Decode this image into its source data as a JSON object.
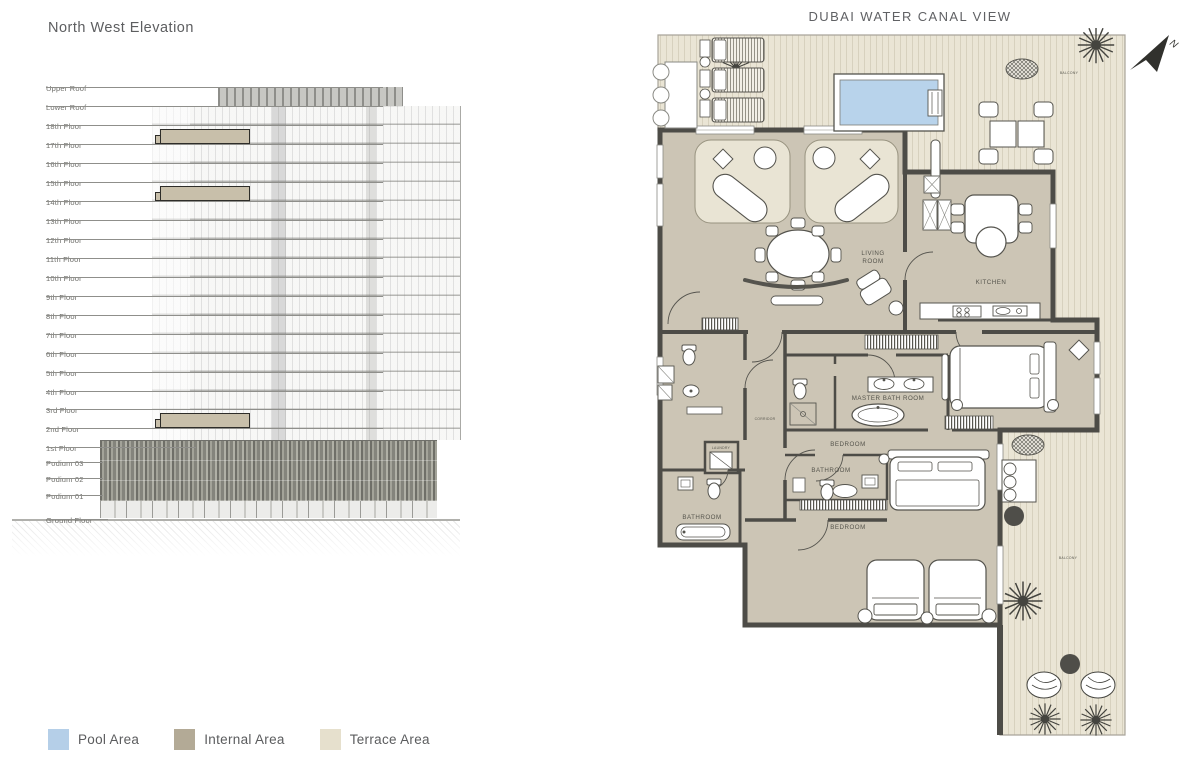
{
  "elevation": {
    "title": "North West Elevation",
    "floors": [
      {
        "label": "Upper Roof",
        "y": 78,
        "line_w": 337,
        "highlight": false
      },
      {
        "label": "Lower Roof",
        "y": 97,
        "line_w": 337,
        "highlight": false
      },
      {
        "label": "18th Floor",
        "y": 116,
        "line_w": 337,
        "highlight": false
      },
      {
        "label": "17th Floor",
        "y": 135,
        "line_w": 337,
        "highlight": true
      },
      {
        "label": "16th Floor",
        "y": 154,
        "line_w": 337,
        "highlight": false
      },
      {
        "label": "15th Floor",
        "y": 173,
        "line_w": 337,
        "highlight": false
      },
      {
        "label": "14th Floor",
        "y": 192,
        "line_w": 337,
        "highlight": true
      },
      {
        "label": "13th Floor",
        "y": 211,
        "line_w": 337,
        "highlight": false
      },
      {
        "label": "12th Floor",
        "y": 230,
        "line_w": 337,
        "highlight": false
      },
      {
        "label": "11th Floor",
        "y": 249,
        "line_w": 337,
        "highlight": false
      },
      {
        "label": "10th Floor",
        "y": 268,
        "line_w": 337,
        "highlight": false
      },
      {
        "label": "9th Floor",
        "y": 287,
        "line_w": 337,
        "highlight": false
      },
      {
        "label": "8th Floor",
        "y": 306,
        "line_w": 337,
        "highlight": false
      },
      {
        "label": "7th Floor",
        "y": 325,
        "line_w": 337,
        "highlight": false
      },
      {
        "label": "6th Floor",
        "y": 344,
        "line_w": 337,
        "highlight": false
      },
      {
        "label": "5th Floor",
        "y": 363,
        "line_w": 337,
        "highlight": false
      },
      {
        "label": "4th Floor",
        "y": 382,
        "line_w": 337,
        "highlight": false
      },
      {
        "label": "3rd Floor",
        "y": 400,
        "line_w": 337,
        "highlight": false
      },
      {
        "label": "2nd Floor",
        "y": 419,
        "line_w": 337,
        "highlight": true
      },
      {
        "label": "1st Floor",
        "y": 438,
        "line_w": 150,
        "highlight": false
      },
      {
        "label": "Podium 03",
        "y": 453,
        "line_w": 57,
        "highlight": false
      },
      {
        "label": "Podium 02",
        "y": 469,
        "line_w": 57,
        "highlight": false
      },
      {
        "label": "Podium 01",
        "y": 486,
        "line_w": 57,
        "highlight": false
      },
      {
        "label": "Ground Floor",
        "y": 510,
        "line_w": 62,
        "highlight": false
      }
    ]
  },
  "floor_plan": {
    "title": "DUBAI WATER CANAL VIEW",
    "north_label": "N",
    "labels": {
      "living_room_line1": "LIVING",
      "living_room_line2": "ROOM",
      "kitchen": "KITCHEN",
      "master_bathroom": "MASTER BATH ROOM",
      "bedroom_1": "BEDROOM",
      "bathroom_1": "BATHROOM",
      "bedroom_2": "BEDROOM",
      "bathroom_2": "BATHROOM",
      "corridor": "CORRIDOR",
      "laundry": "LAUNDRY",
      "balcony_top": "BALCONY",
      "balcony_right": "BALCONY"
    },
    "colors": {
      "pool": "#b8d3eb",
      "internal": "#ccc5b5",
      "terrace": "#eae5d5",
      "wall": "#4d4c47"
    }
  },
  "legend": {
    "items": [
      {
        "label": "Pool Area",
        "color": "#b5cfe8"
      },
      {
        "label": "Internal Area",
        "color": "#b3aa96"
      },
      {
        "label": "Terrace Area",
        "color": "#e6e0cd"
      }
    ]
  }
}
